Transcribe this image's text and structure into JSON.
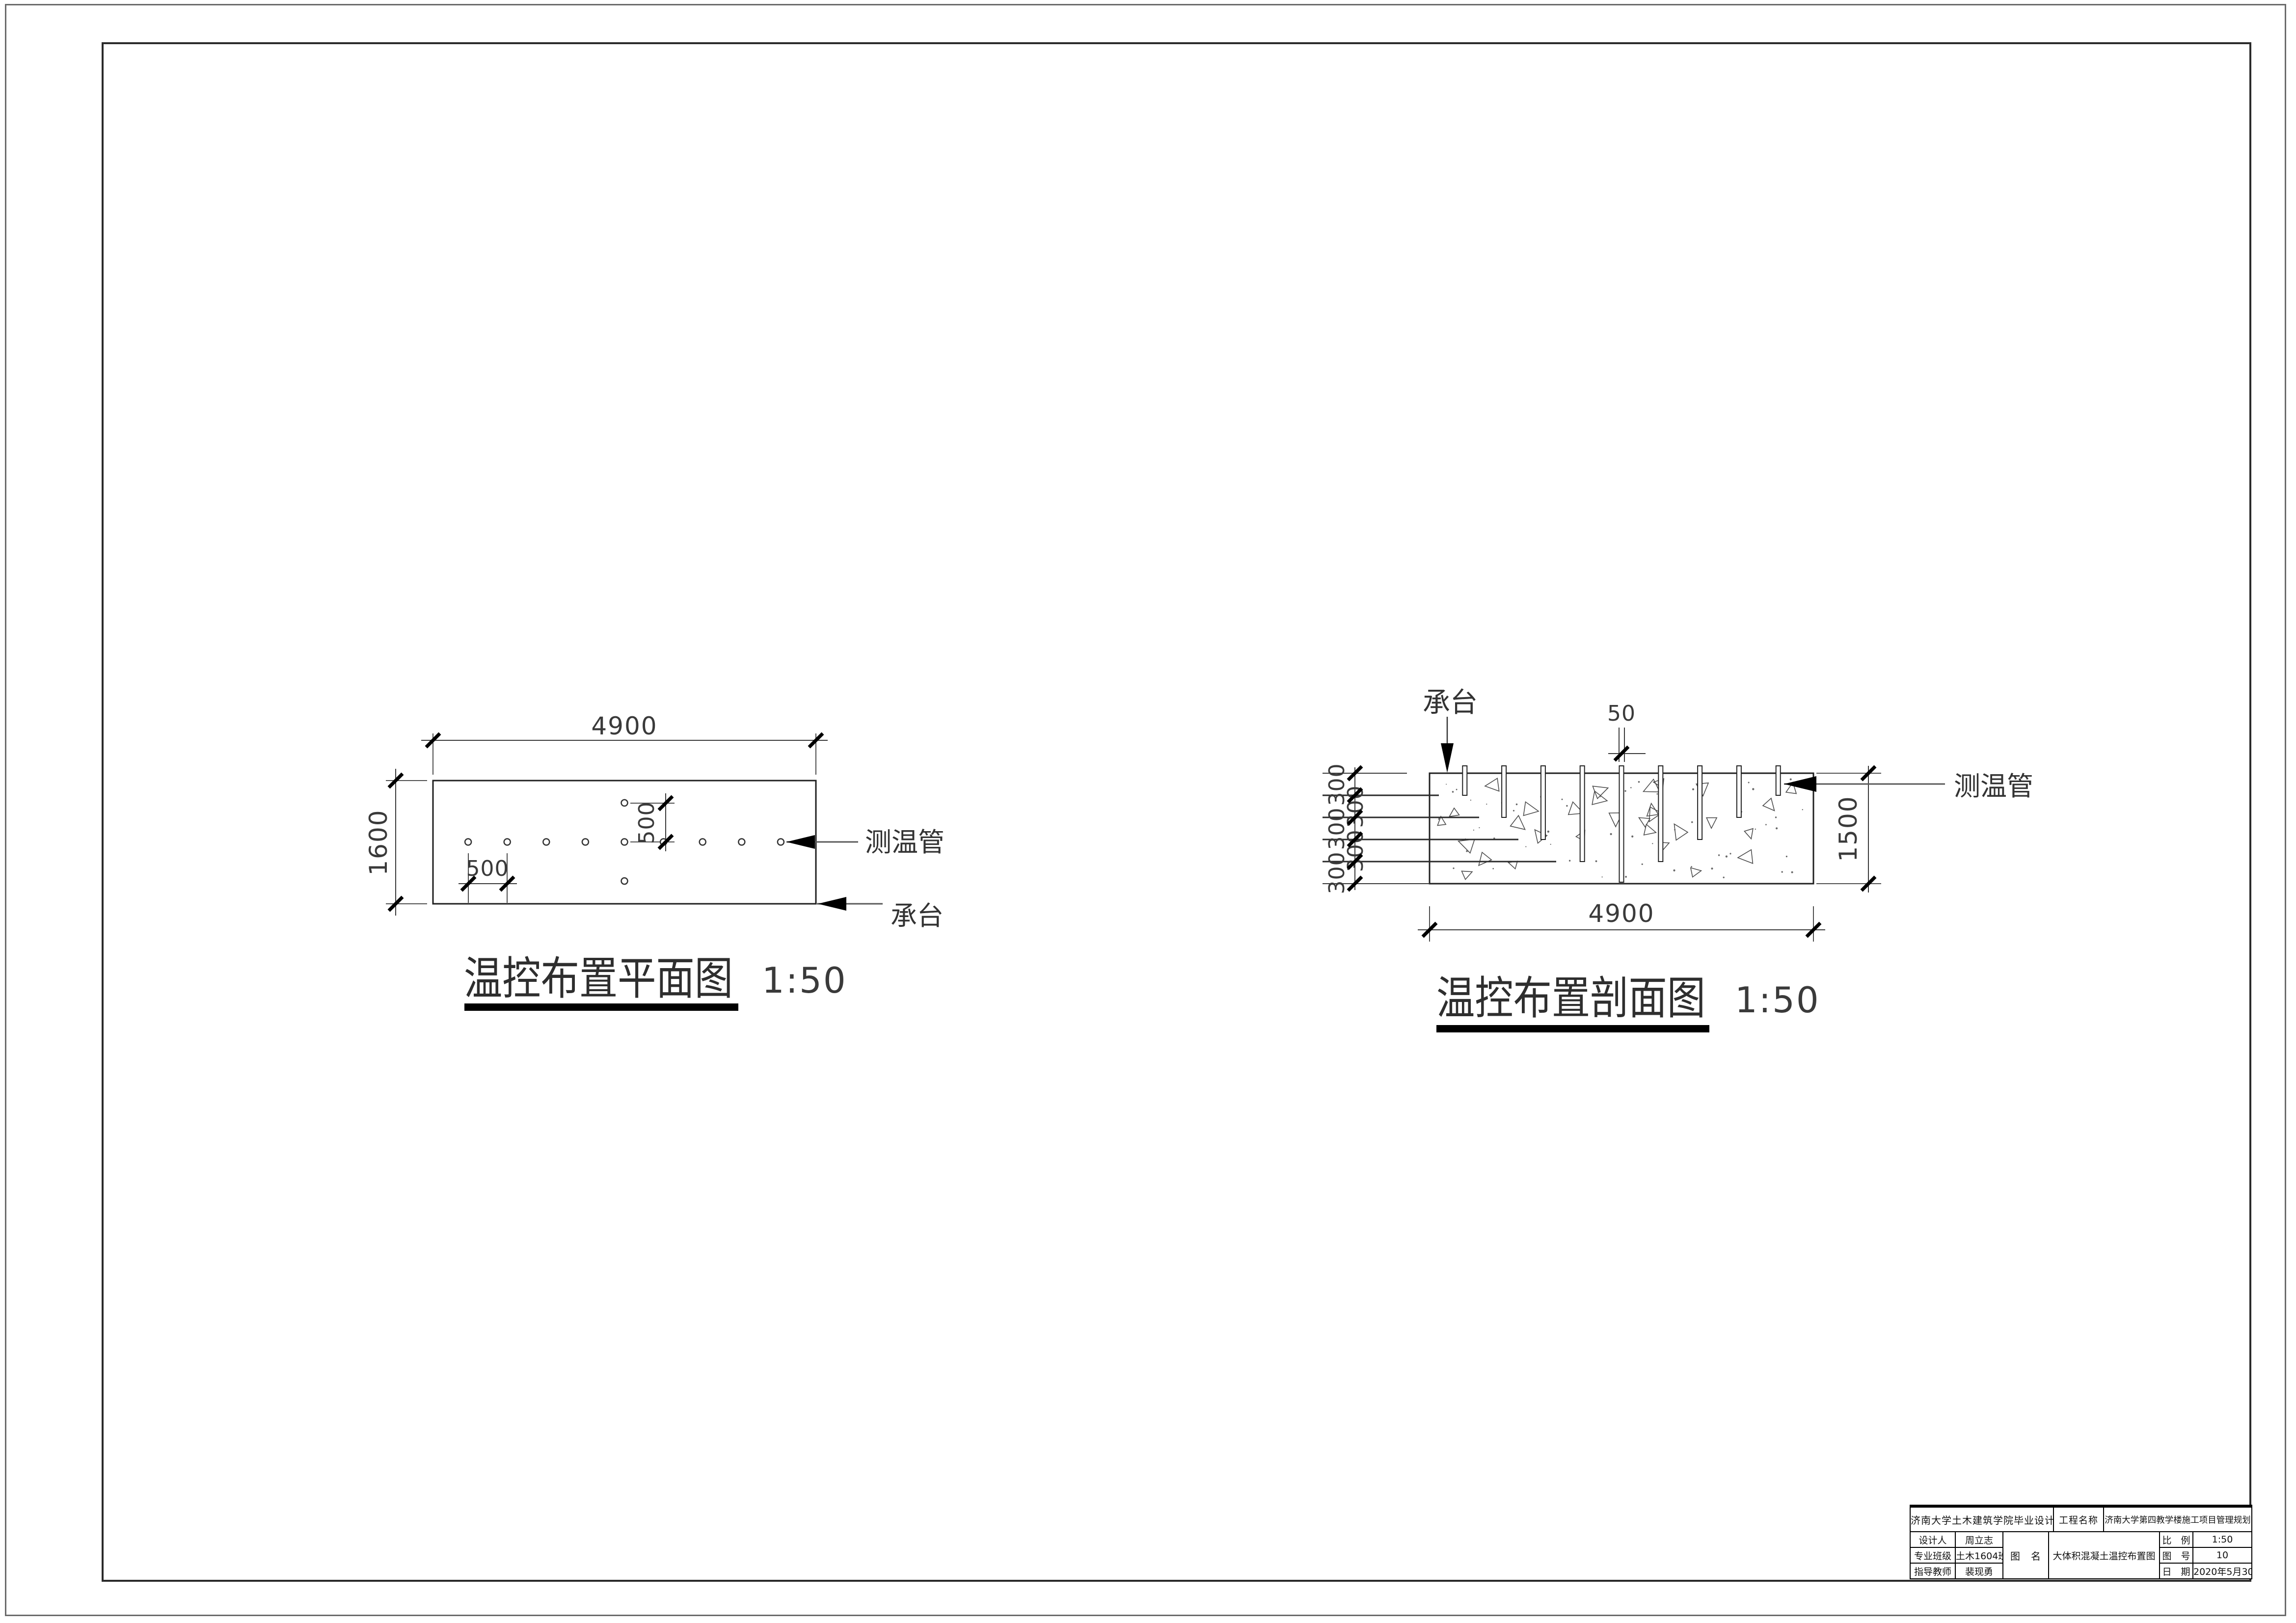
{
  "plan": {
    "title": "温控布置平面图",
    "scale_text": "1:50",
    "dim_width": "4900",
    "dim_height": "1600",
    "dim_spacing": "500",
    "dim_offset": "500",
    "tube_label": "测温管",
    "cap_label": "承台",
    "sensor_count_row": 9,
    "sensor_offset_count": 2
  },
  "section": {
    "title": "温控布置剖面图",
    "scale_text": "1:50",
    "dim_width": "4900",
    "dim_height": "1500",
    "tube_diameter": "50",
    "depth_steps": [
      "300",
      "300",
      "300",
      "300",
      "300"
    ],
    "tube_depths_mm": [
      300,
      600,
      900,
      1200,
      1500,
      1200,
      900,
      600,
      300
    ],
    "tube_label": "测温管",
    "cap_label": "承台"
  },
  "titleblock": {
    "school": "济南大学土木建筑学院毕业设计",
    "project_label": "工程名称",
    "project_name": "济南大学第四教学楼施工项目管理规划",
    "designer_label": "设计人",
    "designer_name": "周立志",
    "class_label": "专业班级",
    "class_name": "土木1604班",
    "advisor_label": "指导教师",
    "advisor_name": "裴现勇",
    "drawing_label": "图　名",
    "drawing_name": "大体积混凝土温控布置图",
    "scale_label": "比　例",
    "scale_value": "1:50",
    "no_label": "图　号",
    "no_value": "10",
    "date_label": "日　期",
    "date_value": "2020年5月30日"
  }
}
